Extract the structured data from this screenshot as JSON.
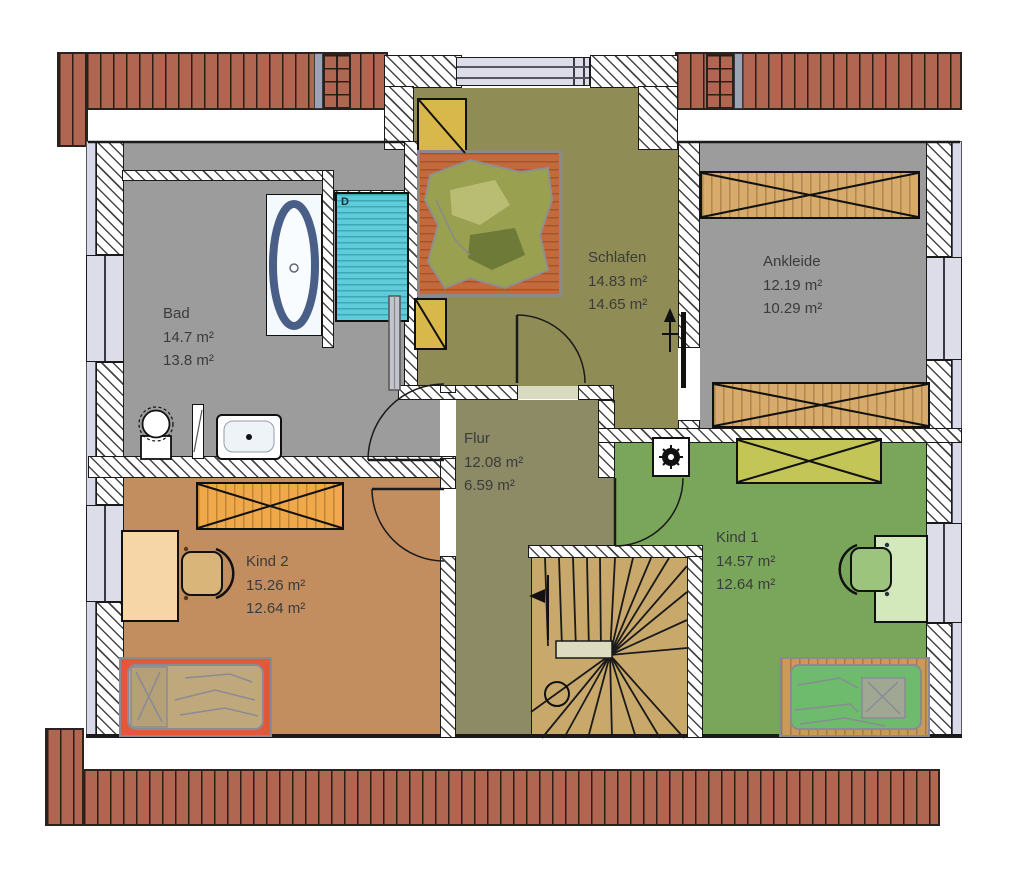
{
  "plan_title": "Obergeschoss Grundriss",
  "rooms": [
    {
      "id": "bad",
      "name": "Bad",
      "area1": "14.7 m²",
      "area2": "13.8 m²"
    },
    {
      "id": "schlafen",
      "name": "Schlafen",
      "area1": "14.83 m²",
      "area2": "14.65 m²"
    },
    {
      "id": "ankleide",
      "name": "Ankleide",
      "area1": "12.19 m²",
      "area2": "10.29 m²"
    },
    {
      "id": "flur",
      "name": "Flur",
      "area1": "12.08 m²",
      "area2": "6.59 m²"
    },
    {
      "id": "kind2",
      "name": "Kind 2",
      "area1": "15.26 m²",
      "area2": "12.64 m²"
    },
    {
      "id": "kind1",
      "name": "Kind 1",
      "area1": "14.57 m²",
      "area2": "12.64 m²"
    }
  ],
  "shower": {
    "label": "D"
  },
  "colors": {
    "roof": "#b06650",
    "bad": "#9c9c9c",
    "ankleide": "#9c9c9c",
    "schlafen": "#8f8c55",
    "flur": "#8c8b66",
    "kind2": "#c28e60",
    "kind1": "#7aa65c",
    "stairs": "#c9a96b",
    "landing": "#dddcc0",
    "window": "#dcdde9",
    "wardrobe_wood": "#d6ab6b",
    "wardrobe_kind1": "#c3c657",
    "wardrobe_kind2": "#efa94b",
    "skylight": "#d8b84a",
    "shower": "#5fccd9",
    "bed_wood": "#c4693c",
    "kind2_bed_frame": "#e4573c",
    "kind2_blanket": "#c0a87d",
    "kind1_bed_frame": "#c99a5a",
    "kind1_blanket": "#6fbb6e",
    "desk_kind2": "#f6d6a6",
    "desk_kind1": "#d4e9bb"
  }
}
